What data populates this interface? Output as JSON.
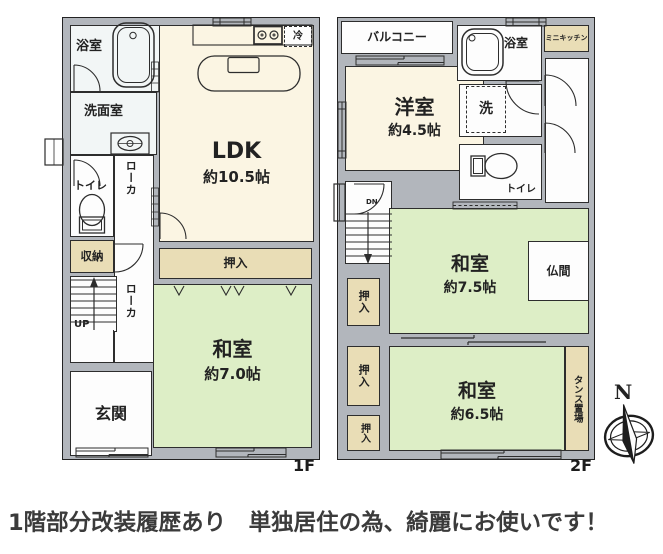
{
  "caption": "1階部分改装履歴あり　単独居住の為、綺麗にお使いです！",
  "floor1": {
    "label": "1F",
    "rooms": {
      "bathroom": "浴室",
      "washroom": "洗面室",
      "toilet": "トイレ",
      "corridor_upper": "ローカ",
      "corridor_lower": "ローカ",
      "storage": "収納",
      "stairs_up": "UP",
      "entrance": "玄関",
      "ldk": "LDK",
      "ldk_size": "約10.5帖",
      "fridge": "冷",
      "closet": "押入",
      "washitsu": "和室",
      "washitsu_size": "約7.0帖"
    }
  },
  "floor2": {
    "label": "2F",
    "rooms": {
      "balcony": "バルコニー",
      "bathroom": "浴室",
      "mini_kitchen": "ミニキッチン",
      "laundry": "洗",
      "toilet": "トイレ",
      "youshitsu": "洋室",
      "youshitsu_size": "約4.5帖",
      "stairs_down": "DN",
      "closet1": "押入",
      "closet2": "押入",
      "closet3": "押入",
      "washitsu_a": "和室",
      "washitsu_a_size": "約7.5帖",
      "butsuma": "仏間",
      "washitsu_b": "和室",
      "washitsu_b_size": "約6.5帖",
      "tansu": "タンス置場"
    }
  },
  "compass": {
    "north_label": "N"
  },
  "colors": {
    "wall": "#b2b6bc",
    "tatami_green": "#ddeec6",
    "room_cream": "#fbf5e3",
    "closet_beige": "#e9ddb6",
    "outline": "#2d2d2d"
  }
}
